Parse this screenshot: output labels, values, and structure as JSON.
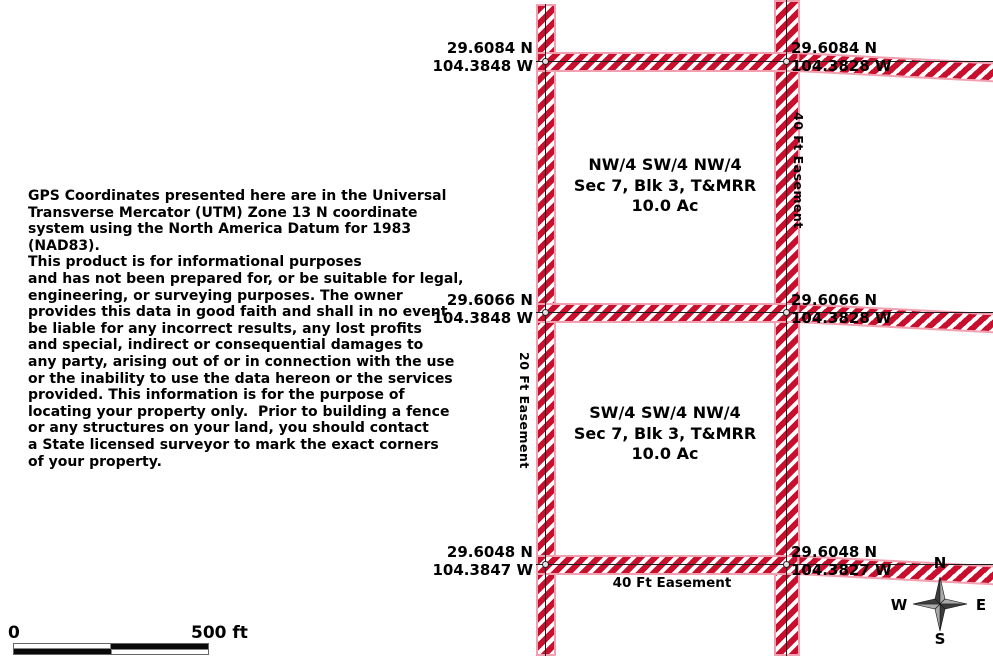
{
  "disclaimer": "GPS Coordinates presented here are in the Universal\nTransverse Mercator (UTM) Zone 13 N coordinate\nsystem using the North America Datum for 1983 (NAD83).\nThis product is for informational purposes\nand has not been prepared for, or be suitable for legal,\nengineering, or surveying purposes. The owner\nprovides this data in good faith and shall in no event\nbe liable for any incorrect results, any lost profits\nand special, indirect or consequential damages to\nany party, arising out of or in connection with the use\nor the inability to use the data hereon or the services\nprovided. This information is for the purpose of\nlocating your property only.  Prior to building a fence\nor any structures on your land, you should contact\na State licensed surveyor to mark the exact corners\nof your property.",
  "map": {
    "corners": [
      {
        "position": "top-left",
        "lat": "29.6084 N",
        "lon": "104.3848 W"
      },
      {
        "position": "top-right",
        "lat": "29.6084 N",
        "lon": "104.3828 W"
      },
      {
        "position": "mid-left",
        "lat": "29.6066 N",
        "lon": "104.3848 W"
      },
      {
        "position": "mid-right",
        "lat": "29.6066 N",
        "lon": "104.3828 W"
      },
      {
        "position": "bottom-left",
        "lat": "29.6048 N",
        "lon": "104.3847 W"
      },
      {
        "position": "bottom-right",
        "lat": "29.6048 N",
        "lon": "104.3827 W"
      }
    ],
    "parcels": [
      {
        "line1": "NW/4 SW/4 NW/4",
        "line2": "Sec 7, Blk 3, T&MRR",
        "line3": "10.0 Ac"
      },
      {
        "line1": "SW/4 SW/4 NW/4",
        "line2": "Sec 7, Blk 3, T&MRR",
        "line3": "10.0 Ac"
      }
    ],
    "easements": {
      "right_vertical": "40 Ft Easement",
      "left_vertical": "20 Ft Easement",
      "bottom_horizontal": "40 Ft Easement"
    },
    "colors": {
      "stripe_red": "#c8102e",
      "stripe_outline": "#f2a0b0",
      "survey_line": "#1c1c1c"
    }
  },
  "scalebar": {
    "zero": "0",
    "max": "500 ft"
  },
  "compass": {
    "n": "N",
    "s": "S",
    "e": "E",
    "w": "W"
  }
}
